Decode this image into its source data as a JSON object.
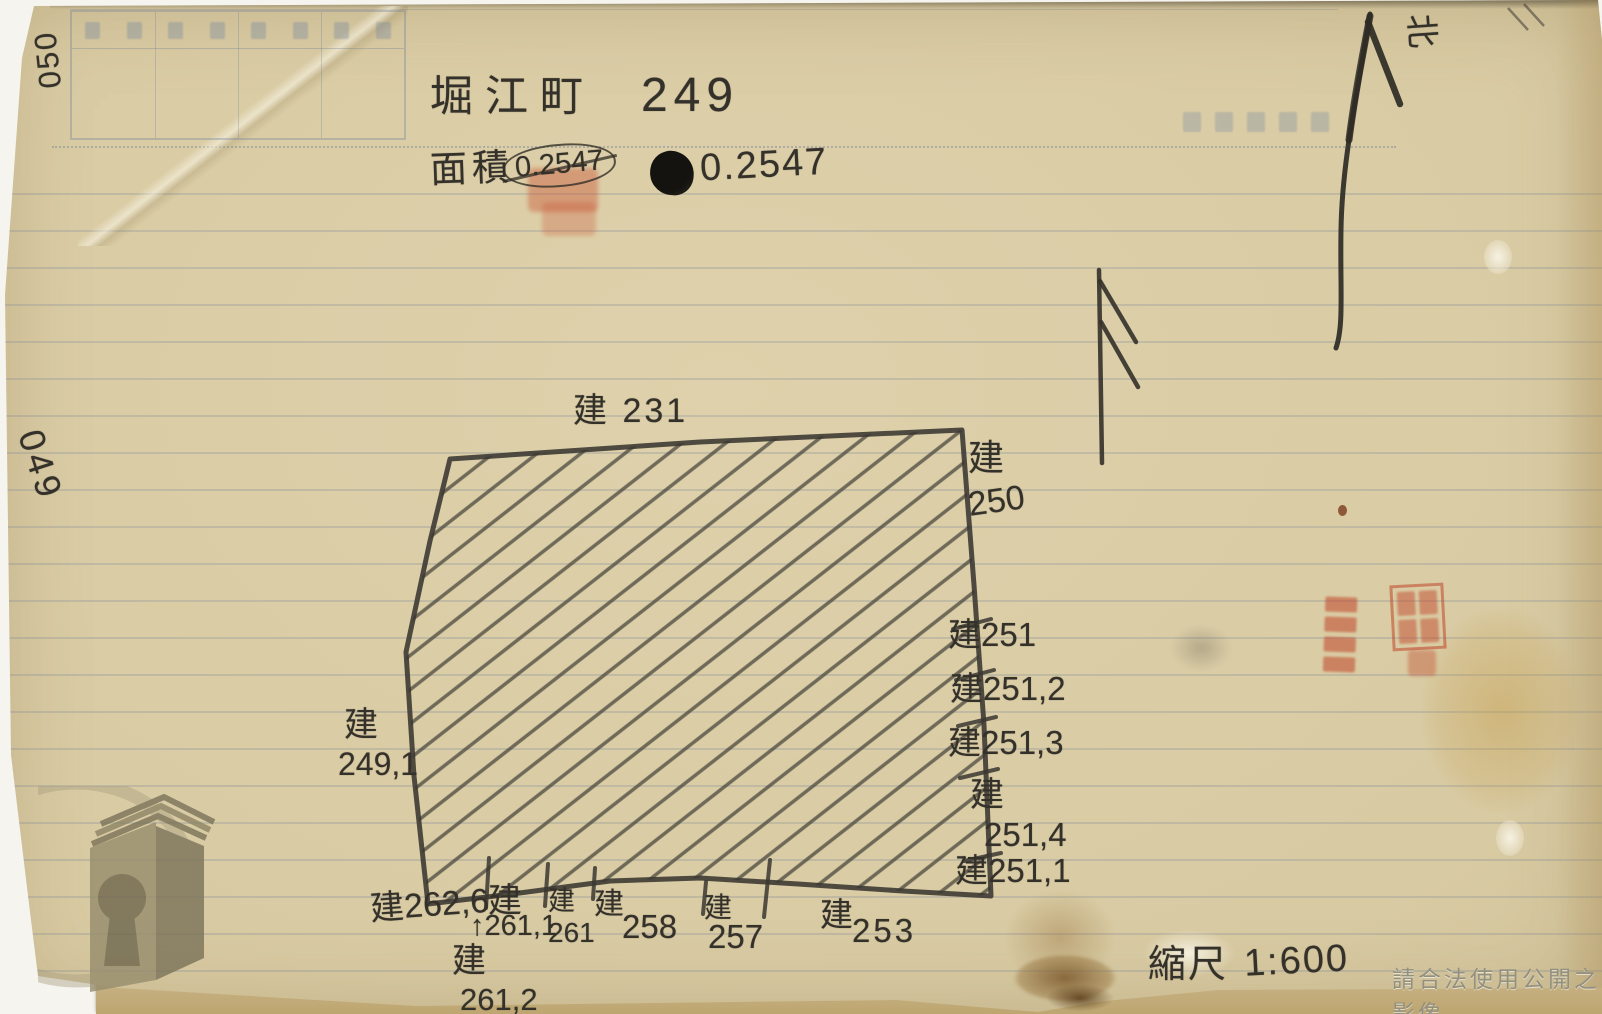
{
  "document": {
    "title_town": "堀江町",
    "title_number": "249",
    "area_label": "面積",
    "area_value_crossed": "0.2547",
    "area_value": "0.2547",
    "north_label": "北",
    "scale_label": "縮尺",
    "scale_value": "1:600",
    "watermark": "請合法使用公開之影像",
    "page_number_top": "050",
    "page_number_middle": "049"
  },
  "parcel": {
    "labels": {
      "top": "建 231",
      "right_top": {
        "char": "建",
        "num": "250"
      },
      "right_1": "建251",
      "right_2": "建251,2",
      "right_3": "建251,3",
      "right_4": {
        "char": "建",
        "num": "251,4"
      },
      "right_5": "建251,1",
      "left": {
        "char": "建",
        "num": "249,1"
      },
      "bottom_1": "建262,6",
      "bottom_2": {
        "char": "建",
        "arrow": "↑",
        "num": "261,1"
      },
      "bottom_3": {
        "char": "建",
        "num": "261"
      },
      "bottom_4": {
        "char": "建",
        "num": "258"
      },
      "bottom_5": {
        "char": "建",
        "num": "257"
      },
      "bottom_6": {
        "char": "建",
        "num": "253"
      },
      "bottom_7": {
        "char": "建",
        "num": "261,2"
      }
    }
  },
  "colors": {
    "paper": "#d8caa2",
    "pencil": "#35322b",
    "seal_red": "#c0452a",
    "rule_blue": "#68789a"
  }
}
